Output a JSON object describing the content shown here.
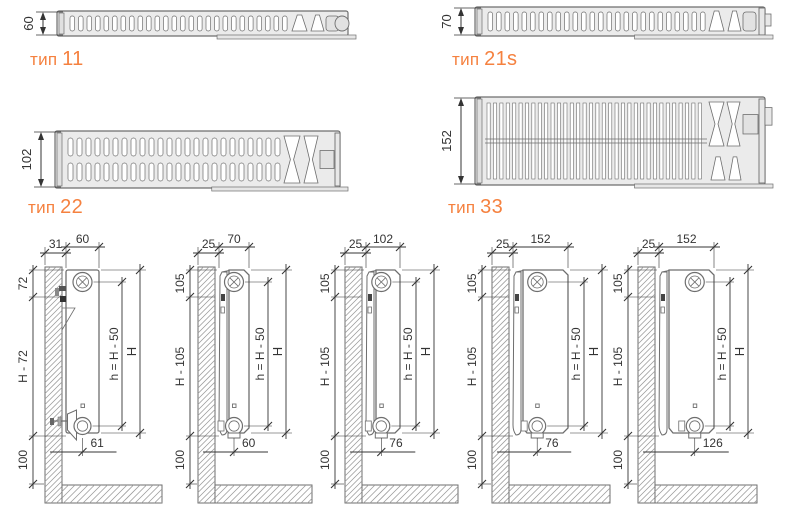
{
  "colors": {
    "accent": "#f5813f",
    "line": "#6e6e6e",
    "dim_text": "#343434",
    "section_fill": "#ebebeb",
    "hatch": "#9b9b9b"
  },
  "sections": [
    {
      "type_prefix": "тип",
      "type_value": "11",
      "depth_label": "60"
    },
    {
      "type_prefix": "тип",
      "type_value": "21s",
      "depth_label": "70"
    },
    {
      "type_prefix": "тип",
      "type_value": "22",
      "depth_label": "102"
    },
    {
      "type_prefix": "тип",
      "type_value": "33",
      "depth_label": "152"
    }
  ],
  "installation_diagrams": [
    {
      "top_dims": [
        "31",
        "60"
      ],
      "left_dims": [
        "72",
        "H - 72",
        "100"
      ],
      "right_dims": [
        "h = H - 50",
        "H"
      ],
      "bottom_dim": "61"
    },
    {
      "top_dims": [
        "25",
        "70"
      ],
      "left_dims": [
        "105",
        "H - 105",
        "100"
      ],
      "right_dims": [
        "h = H - 50",
        "H"
      ],
      "bottom_dim": "60"
    },
    {
      "top_dims": [
        "25",
        "102"
      ],
      "left_dims": [
        "105",
        "H - 105",
        "100"
      ],
      "right_dims": [
        "h = H - 50",
        "H"
      ],
      "bottom_dim": "76"
    },
    {
      "top_dims": [
        "25",
        "152"
      ],
      "left_dims": [
        "105",
        "H - 105",
        "100"
      ],
      "right_dims": [
        "h = H - 50",
        "H"
      ],
      "bottom_dim": "76"
    },
    {
      "top_dims": [
        "25",
        "152"
      ],
      "left_dims": [
        "105",
        "H - 105",
        "100"
      ],
      "right_dims": [
        "h = H - 50",
        "H"
      ],
      "bottom_dim": "126"
    }
  ]
}
